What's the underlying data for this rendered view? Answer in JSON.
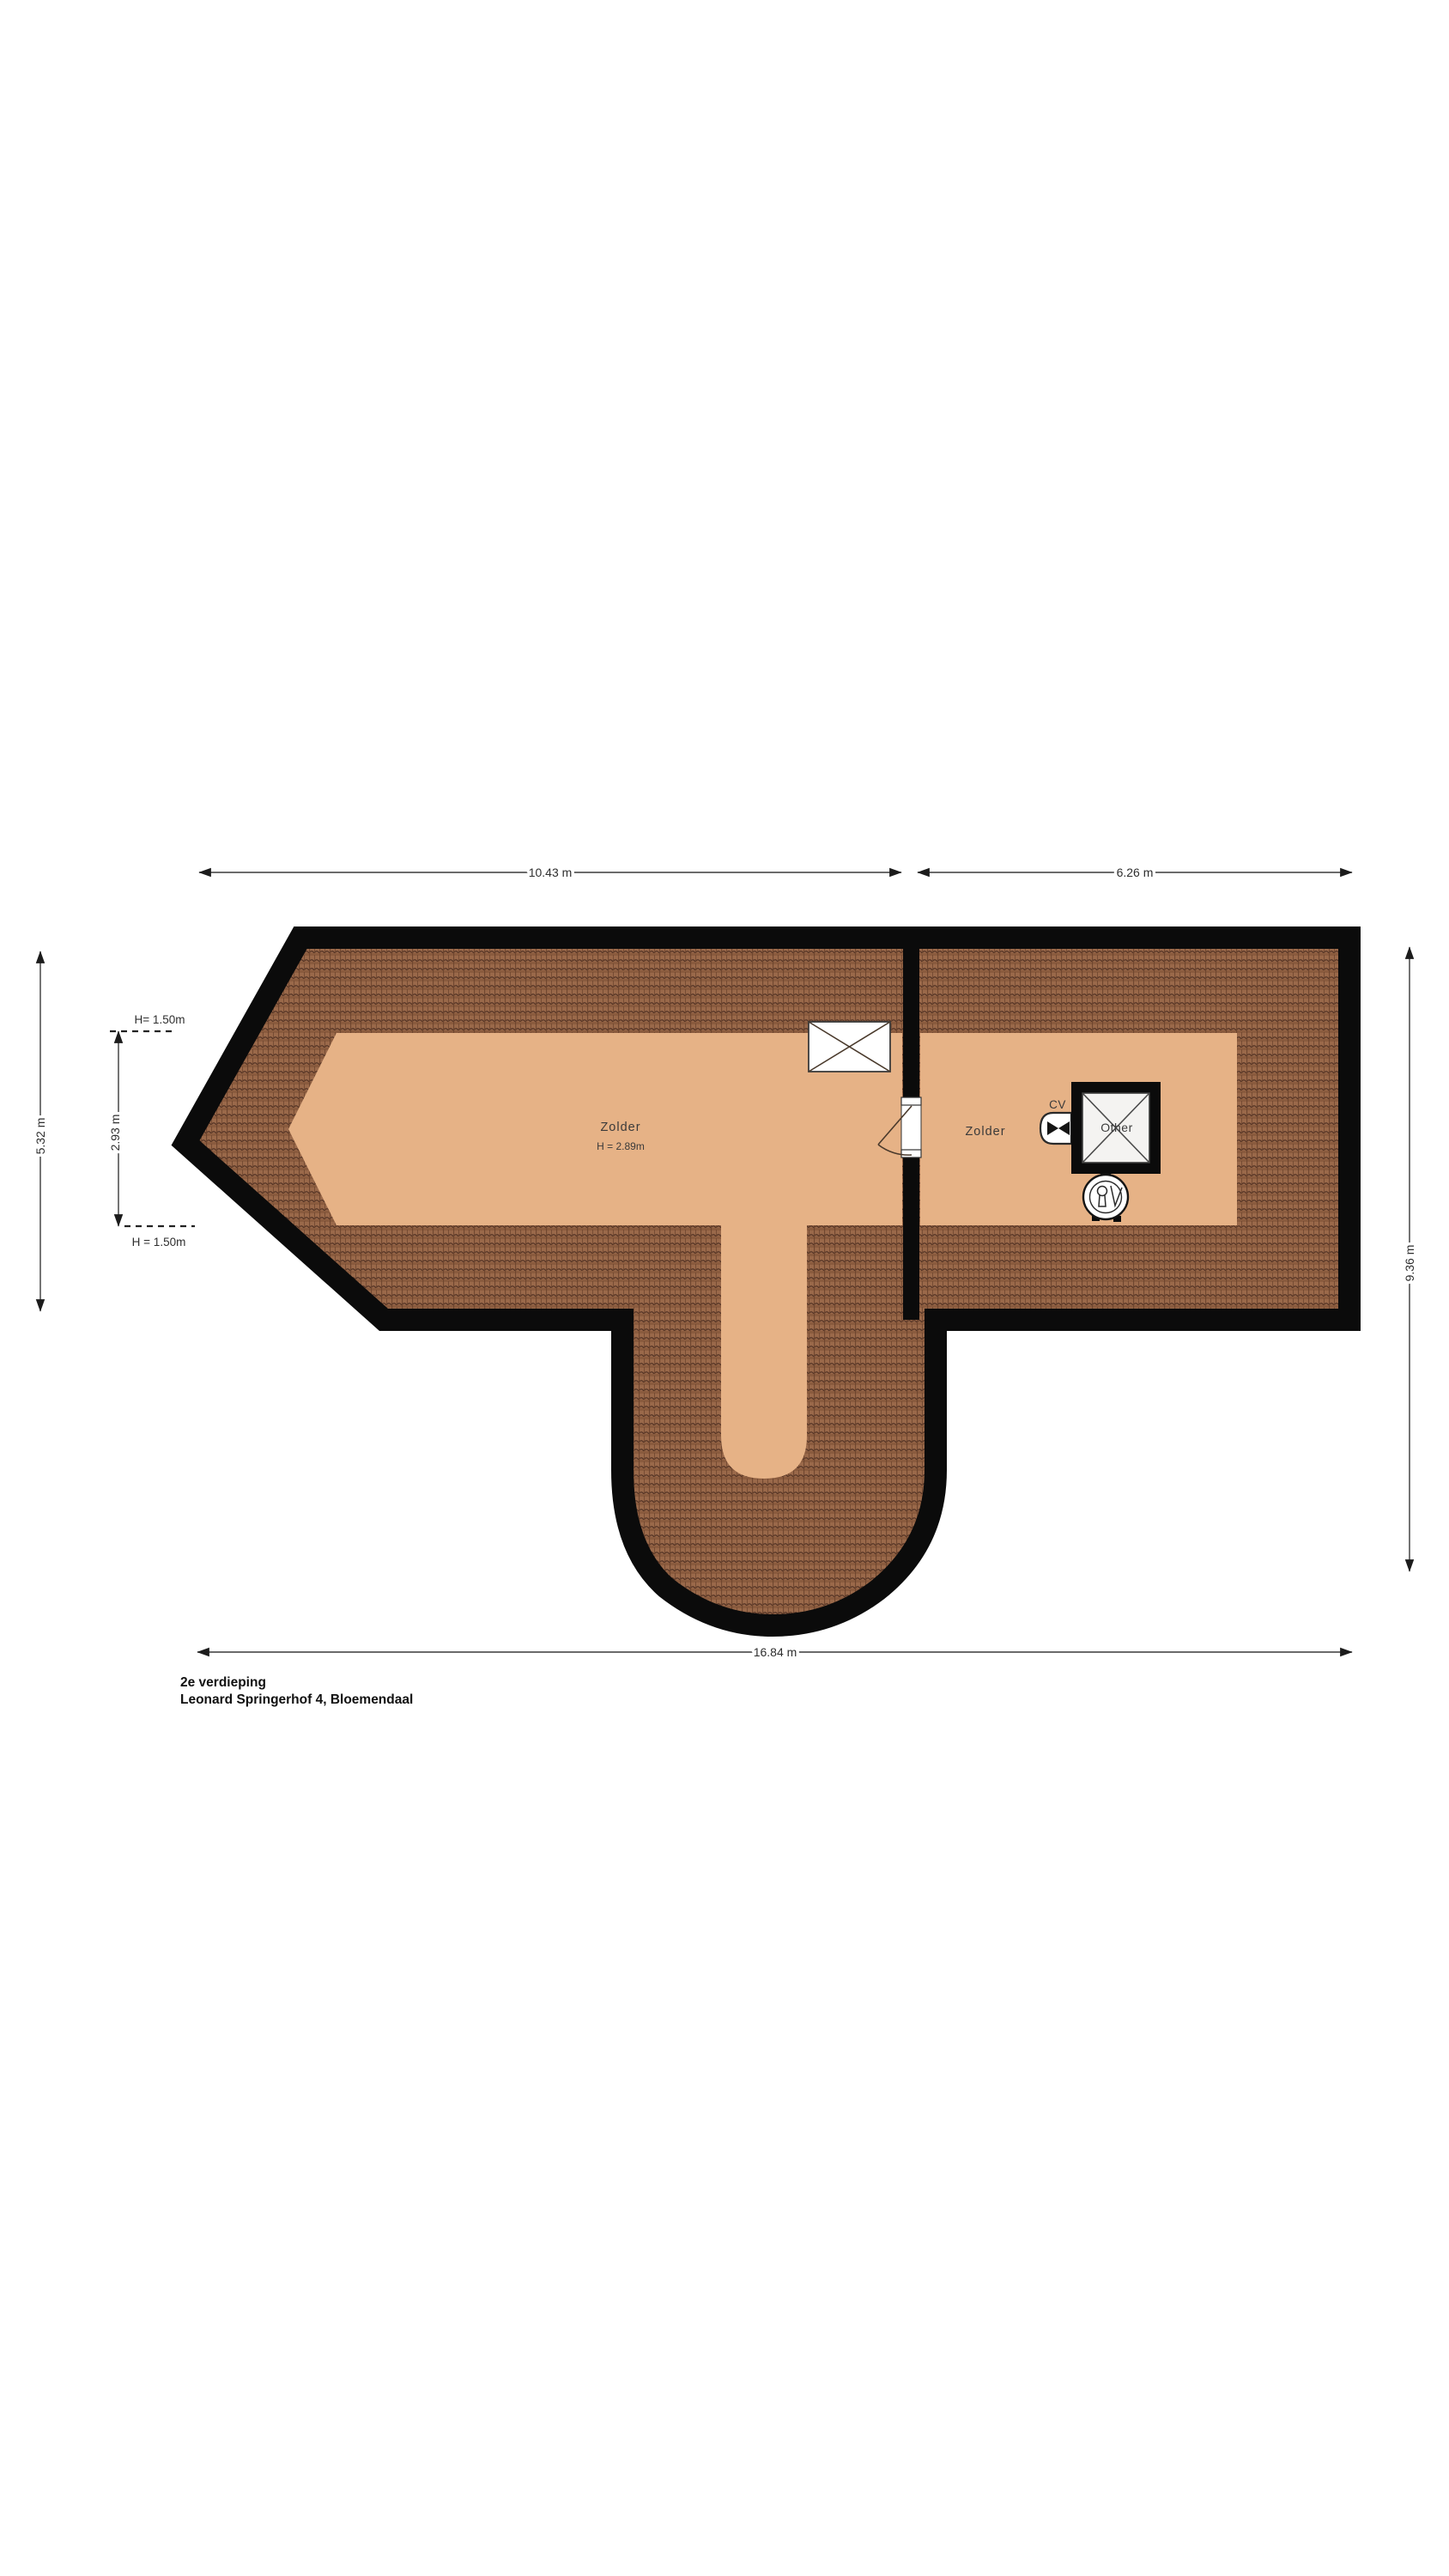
{
  "title_block": {
    "line1": "2e verdieping",
    "line2": "Leonard Springerhof 4, Bloemendaal"
  },
  "dimensions": {
    "top_left": "10.43 m",
    "top_right": "6.26 m",
    "bottom": "16.84 m",
    "right": "9.36 m",
    "left_outer": "5.32 m",
    "left_inner": "2.93 m",
    "knee_wall_top": "H= 1.50m",
    "knee_wall_bottom": "H = 1.50m"
  },
  "rooms": {
    "zolder_left": {
      "label": "Zolder",
      "ceiling_height": "H = 2.89m"
    },
    "zolder_right": {
      "label": "Zolder"
    },
    "shaft": {
      "label": "Other"
    },
    "cv_unit": {
      "label": "CV"
    }
  },
  "colors": {
    "wall": "#0b0b0b",
    "floor": "#e6b286",
    "roof_tile": "#9a694a",
    "roof_tile_dark": "#543425",
    "dimension_line": "#3a3a3a",
    "text": "#2e2e2e"
  }
}
